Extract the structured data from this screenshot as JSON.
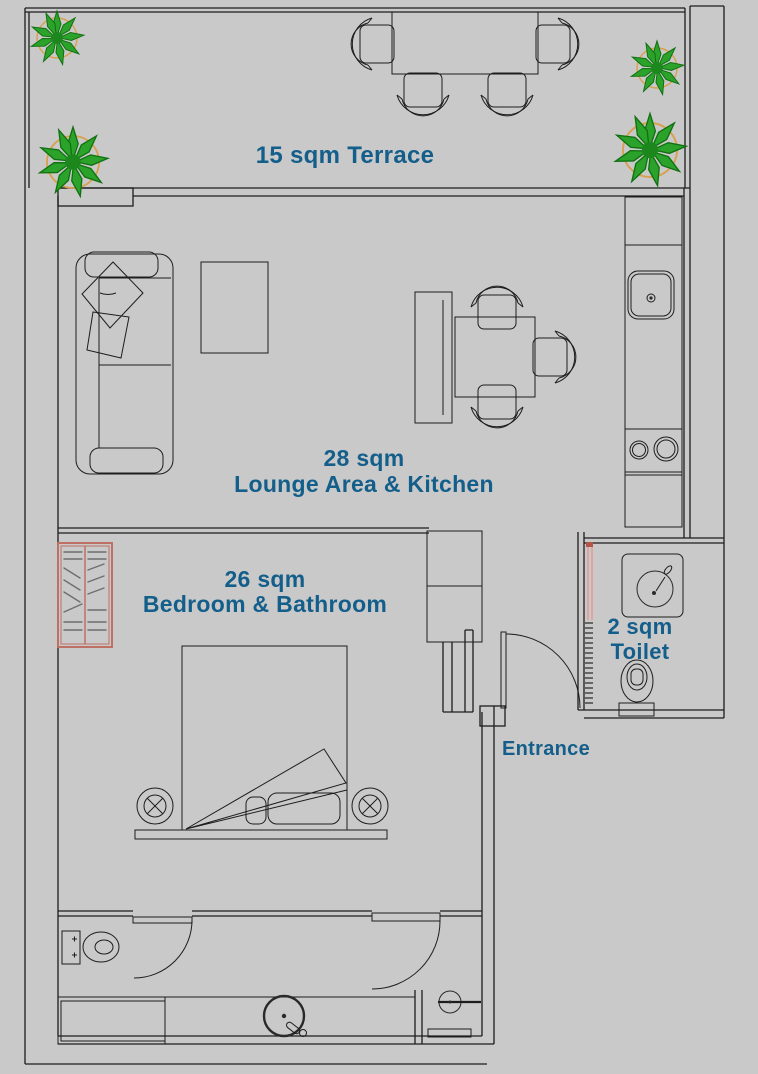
{
  "title": "Apartment floor plan",
  "colors": {
    "background": "#c9c9c9",
    "line": "#1d1d1d",
    "label_blue": "#135e8a",
    "plant_green": "#2ba32b",
    "plant_outline": "#117011",
    "plant_pot_orange": "#d8a04e",
    "wardrobe_salmon": "#bf7065",
    "sliding_door_pink": "#e59c95",
    "shelf_gray": "#6e6e6e"
  },
  "rooms": {
    "terrace": {
      "label": "15 sqm Terrace",
      "area_sqm": 15
    },
    "lounge": {
      "area_label": "28 sqm",
      "name_label": "Lounge Area & Kitchen",
      "area_sqm": 28
    },
    "bedroom": {
      "area_label": "26 sqm",
      "name_label": "Bedroom & Bathroom",
      "area_sqm": 26
    },
    "toilet": {
      "area_label": "2 sqm",
      "name_label": "Toilet",
      "area_sqm": 2
    },
    "entrance": {
      "label": "Entrance"
    }
  },
  "fixtures": [
    "dining-table-terrace",
    "terrace-chairs-x4",
    "potted-plants-x4",
    "sofa-with-pillows",
    "side-table",
    "dining-bench",
    "dining-table",
    "dining-chairs-x3",
    "kitchen-counter",
    "kitchen-sink",
    "cooktop-2-burners",
    "kitchen-cabinets",
    "wardrobe",
    "closet",
    "double-bed",
    "bed-pillows",
    "bedside-lamps-x2",
    "entrance-door-swing",
    "bathroom-door-swing",
    "shower-door-swing",
    "toilet-sliding-door",
    "toilet-vanity-washbasin",
    "toilet-wc",
    "bathroom-wc",
    "bathroom-cabinet",
    "bathroom-round-washbasin",
    "shower-head",
    "shower-sill"
  ]
}
